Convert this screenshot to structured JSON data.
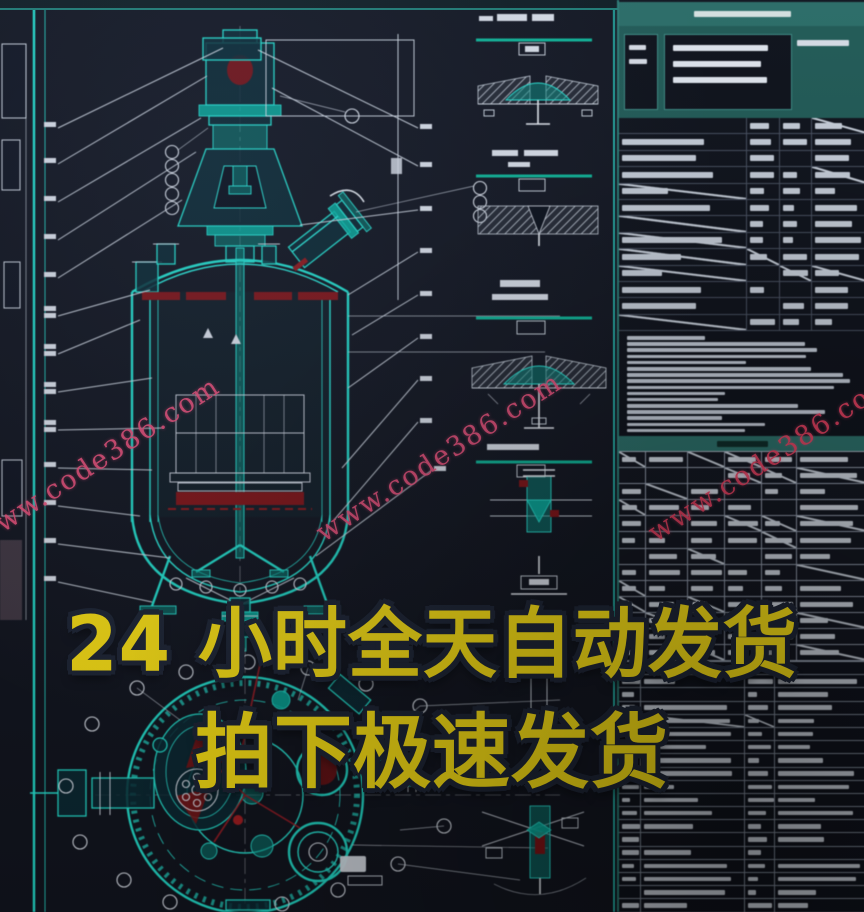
{
  "overlay": {
    "line1": "24 小时全天自动发货",
    "line2": "拍下极速发货",
    "fill_color": "#ffe414",
    "outline_color": "#1e2535"
  },
  "watermark": {
    "text": "www.code386.com",
    "color": "#f0517c",
    "count": 3
  },
  "palette": {
    "background": "#12151f",
    "cad_line_cyan": "#35e5d6",
    "cad_fill_teal": "#12b2a2",
    "leader_white": "#dfe5ee",
    "highlight_red": "#7c1518",
    "table_band_teal": "#2b6f68",
    "grid_light": "#9aa3b0"
  },
  "greek": {
    "blocks": {
      "header": {
        "n": 1,
        "min": 34,
        "max": 40,
        "h": 6,
        "gap": 0,
        "center": true,
        "color": "#dfe9e7"
      },
      "tb_left": {
        "n": 2,
        "min": 55,
        "max": 75,
        "h": 5,
        "gap": 9,
        "color": "#dfe4ec"
      },
      "tb_mid": {
        "n": 3,
        "min": 62,
        "max": 94,
        "h": 6,
        "gap": 10,
        "color": "#e8edf4"
      },
      "tb_right": {
        "n": 1,
        "min": 74,
        "max": 86,
        "h": 6,
        "gap": 0,
        "color": "#dfe4ec"
      },
      "band2": {
        "n": 1,
        "min": 18,
        "max": 24,
        "h": 6,
        "gap": 0,
        "center": true,
        "color": "#0d2a26"
      },
      "notes": {
        "n": 16,
        "min": 30,
        "max": 96,
        "h": 3.6,
        "gap": 2.6,
        "color": "#c6cdd8"
      }
    },
    "tables": {
      "char": {
        "rows": 13,
        "rowH": 16.4,
        "cols": [
          52,
          13,
          13,
          22
        ],
        "barH": 6,
        "min": 30,
        "max": 88,
        "slash": 0.22,
        "grid": "#49505f",
        "bar": "#ccd3dd"
      },
      "nozzle": {
        "rows": 13,
        "rowH": 16.1,
        "cols": [
          11,
          17,
          15,
          15,
          14,
          28
        ],
        "barH": 5,
        "min": 35,
        "max": 85,
        "slash": 0.3,
        "grid": "#939cab",
        "bar": "#d2d8e1"
      },
      "bom": {
        "rows": 19,
        "rowH": 13.2,
        "cols": [
          9,
          42,
          12,
          37
        ],
        "barH": 4.5,
        "min": 25,
        "max": 92,
        "slash": 0.06,
        "grid": "#7f8896",
        "bar": "#ccd2db"
      }
    }
  }
}
